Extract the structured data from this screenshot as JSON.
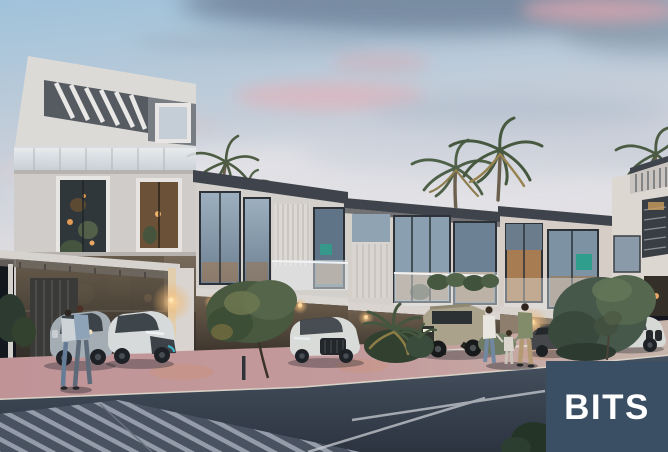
{
  "image": {
    "description": "Dusk architectural rendering of a modern white townhouse row with carports, parked cars, palm trees, shrubs and residents walking on a pink paved sidewalk beside a dark asphalt road with a striped crosswalk"
  },
  "watermark": {
    "text": "BITS",
    "background_color": "#3a4f63",
    "text_color": "#ffffff"
  },
  "palette": {
    "sky_top": "#9fc2da",
    "sky_mid": "#c3cdd9",
    "sky_horizon": "#e2dee1",
    "cloud_slate": "#73869d",
    "cloud_pink": "#d4a9b3",
    "building_white": "#d6d2ce",
    "roof_fascia": "#3f444c",
    "window_glass": "#8aa0b0",
    "interior_warm": "#b07c4c",
    "teal_accent": "#2f9e8c",
    "foliage_dark": "#3c4e3d",
    "foliage_light": "#5d7049",
    "pavement_pink": "#c39a9c",
    "road_dark": "#2c3440",
    "road_light": "#414c5a",
    "crosswalk_stripe": "#98a1ad"
  }
}
